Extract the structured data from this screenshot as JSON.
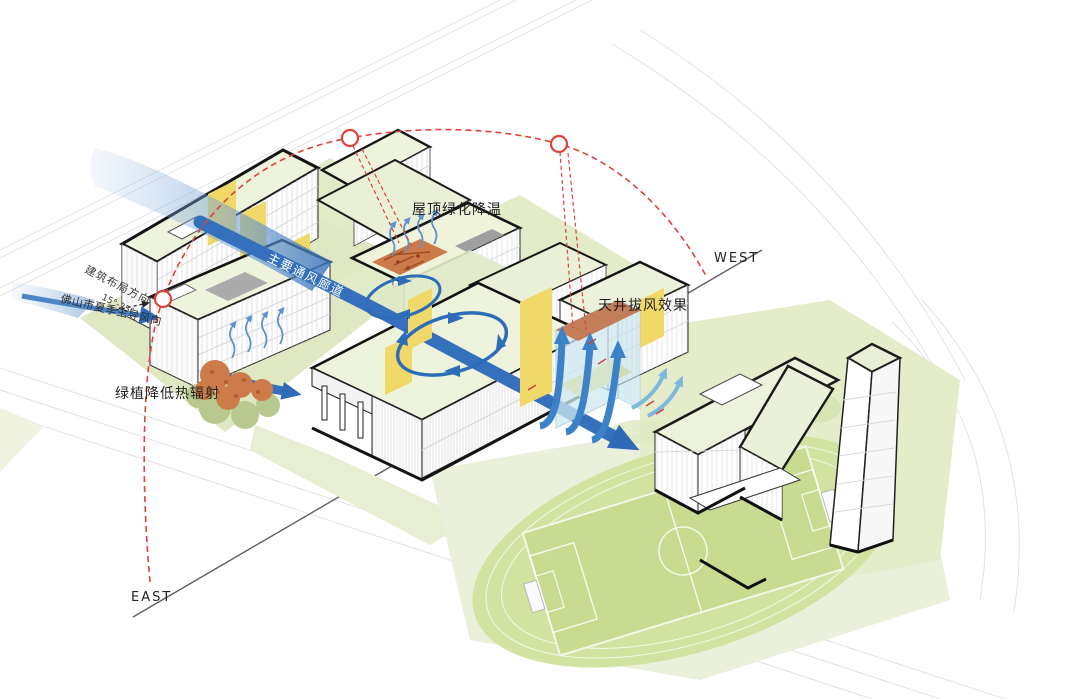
{
  "diagram": {
    "labels": {
      "roof_greening": "屋顶绿化降温",
      "atrium_stack": "天井拔风效果",
      "greenery_radiation": "绿植降低热辐射",
      "main_corridor": "主要通风廊道",
      "layout_direction": "建筑布局方向",
      "layout_angle": "15°-25°",
      "summer_wind": "佛山市夏季主导风向"
    },
    "compass": {
      "east": "EAST",
      "west": "WEST"
    },
    "colors": {
      "wind_blue": "#3470bc",
      "wind_light_blue": "#8db5e2",
      "sun_red": "#e2403a",
      "highlight_yellow": "#f0d968",
      "heat_orange": "#cc7a4a",
      "glass_blue": "#cfe9ef",
      "lawn_green": "#dfe8c2",
      "track_green": "#d2e2a0",
      "field_green": "#c8db90",
      "roof_green": "#eef3dc",
      "outline_black": "#1a1a1a"
    }
  }
}
